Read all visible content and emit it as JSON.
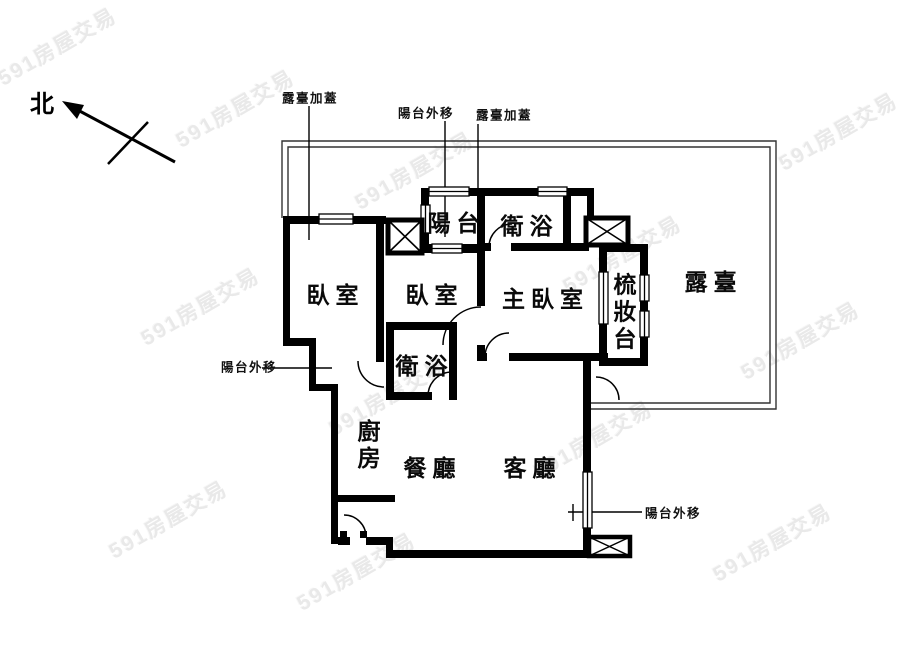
{
  "canvas": {
    "width": 900,
    "height": 657,
    "background": "#ffffff",
    "line_color": "#000000"
  },
  "compass": {
    "label": "北"
  },
  "rooms": [
    {
      "id": "bedroom-1",
      "label": "臥室",
      "x": 334,
      "y": 293,
      "vertical": false
    },
    {
      "id": "balcony",
      "label": "陽台",
      "x": 455,
      "y": 221,
      "vertical": false
    },
    {
      "id": "bathroom-1",
      "label": "衛浴",
      "x": 528,
      "y": 224,
      "vertical": false
    },
    {
      "id": "bedroom-2",
      "label": "臥室",
      "x": 433,
      "y": 293,
      "vertical": false
    },
    {
      "id": "master-bedroom",
      "label": "主臥室",
      "x": 544,
      "y": 297,
      "vertical": false
    },
    {
      "id": "dressing-table",
      "label": "梳妝台",
      "x": 622,
      "y": 313,
      "vertical": true
    },
    {
      "id": "terrace",
      "label": "露臺",
      "x": 712,
      "y": 280,
      "vertical": false
    },
    {
      "id": "bathroom-2",
      "label": "衛浴",
      "x": 423,
      "y": 364,
      "vertical": false
    },
    {
      "id": "kitchen",
      "label": "廚房",
      "x": 366,
      "y": 446,
      "vertical": true
    },
    {
      "id": "dining-room",
      "label": "餐廳",
      "x": 431,
      "y": 466,
      "vertical": false
    },
    {
      "id": "living-room",
      "label": "客廳",
      "x": 531,
      "y": 466,
      "vertical": false
    }
  ],
  "annotations": [
    {
      "id": "terrace-addition-left",
      "label": "露臺加蓋",
      "x": 310,
      "y": 97
    },
    {
      "id": "balcony-moved-out-top",
      "label": "陽台外移",
      "x": 426,
      "y": 112
    },
    {
      "id": "terrace-addition-right",
      "label": "露臺加蓋",
      "x": 504,
      "y": 114
    },
    {
      "id": "balcony-moved-out-left",
      "label": "陽台外移",
      "x": 249,
      "y": 366
    },
    {
      "id": "balcony-moved-out-bottom",
      "label": "陽台外移",
      "x": 673,
      "y": 512
    }
  ],
  "watermark": {
    "text": "591房屋交易",
    "color": "#e9e9e9",
    "instances": [
      {
        "x": 57,
        "y": 46
      },
      {
        "x": 235,
        "y": 108
      },
      {
        "x": 414,
        "y": 170
      },
      {
        "x": 838,
        "y": 131
      },
      {
        "x": 200,
        "y": 306
      },
      {
        "x": 622,
        "y": 254
      },
      {
        "x": 800,
        "y": 340
      },
      {
        "x": 388,
        "y": 396
      },
      {
        "x": 593,
        "y": 439
      },
      {
        "x": 168,
        "y": 519
      },
      {
        "x": 772,
        "y": 542
      },
      {
        "x": 356,
        "y": 571
      }
    ]
  }
}
